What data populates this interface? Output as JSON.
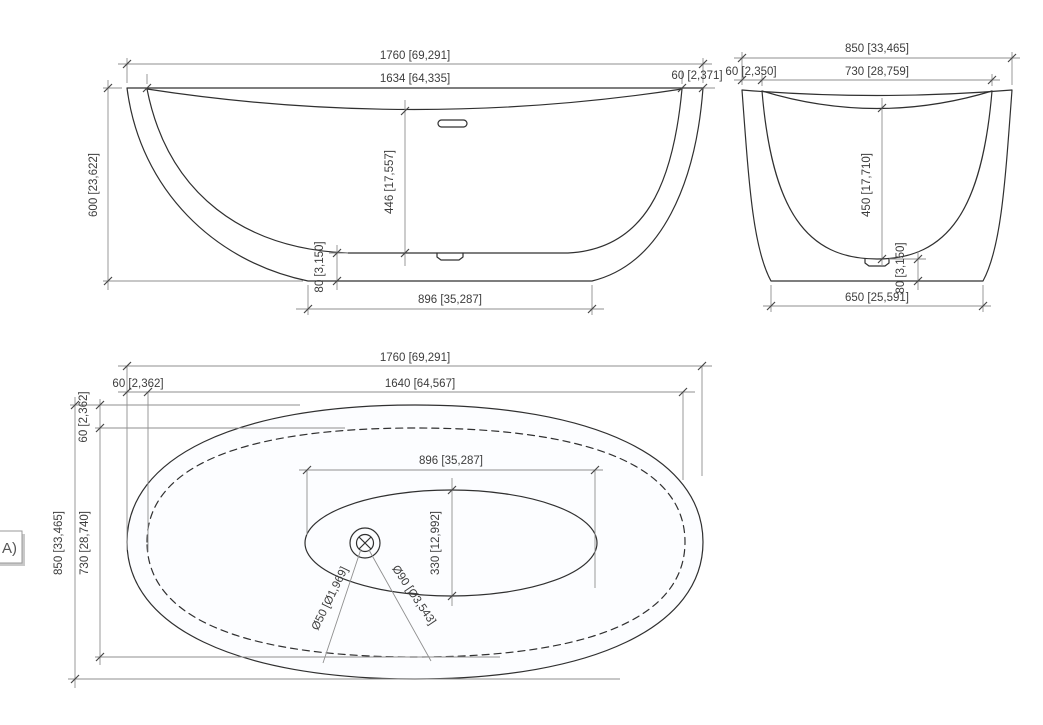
{
  "drawing": {
    "view_label": "A)",
    "line_color": "#303030",
    "dim_color": "#8f8f8f",
    "front_view": {
      "total_width": "1760 [69,291]",
      "rim_width": "1634 [64,335]",
      "rim_offset": "60 [2,371]",
      "height": "600 [23,622]",
      "inner_depth": "446 [17,557]",
      "base_height": "80 [3,150]",
      "base_width": "896 [35,287]"
    },
    "side_view": {
      "total_width": "850 [33,465]",
      "rim_offset": "60 [2,350]",
      "rim_width": "730 [28,759]",
      "inner_depth": "450 [17,710]",
      "base_height": "80 [3,150]",
      "base_width": "650 [25,591]"
    },
    "top_view": {
      "total_length": "1760 [69,291]",
      "rim_offset_h": "60 [2,362]",
      "rim_length": "1640 [64,567]",
      "rim_offset_v": "60 [2,362]",
      "total_width": "850 [33,465]",
      "rim_width": "730 [28,740]",
      "basin_length": "896 [35,287]",
      "basin_width": "330 [12,992]",
      "drain_diameter": "Ø50 [Ø1,969]",
      "overflow_pipe_diameter": "Ø90 [Ø3,543]"
    }
  }
}
